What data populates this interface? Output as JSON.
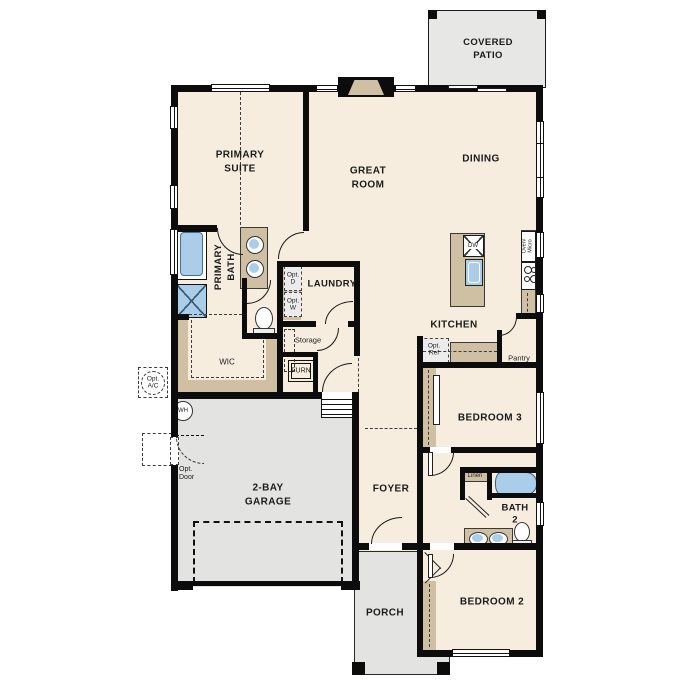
{
  "colors": {
    "wall": "#0c0c0c",
    "floor": "#f6edde",
    "concrete": "#e3e3e1",
    "patio": "#e7e7e5",
    "casework": "#cfc0a4",
    "fixture_blue": "#aacdea",
    "opt_fill": "#ececec"
  },
  "rooms": {
    "covered_patio": "COVERED\nPATIO",
    "primary_suite": "PRIMARY\nSUITE",
    "great_room": "GREAT\nROOM",
    "dining": "DINING",
    "kitchen": "KITCHEN",
    "laundry": "LAUNDRY",
    "primary_bath": "PRIMARY\nBATH",
    "wic": "WIC",
    "bedroom_3": "BEDROOM 3",
    "bath_2": "BATH\n2",
    "bedroom_2": "BEDROOM 2",
    "foyer": "FOYER",
    "garage": "2-BAY\nGARAGE",
    "porch": "PORCH",
    "storage": "Storage",
    "pantry": "Pantry",
    "linen": "Linen"
  },
  "fixtures": {
    "furnace": "FURN",
    "water_heater": "WH",
    "dishwasher": "DW",
    "oven_micro": "Oven/\nMicro",
    "opt_dryer": "Opt.\nD",
    "opt_washer": "Opt.\nW",
    "opt_refrigerator": "Opt.\nRef",
    "opt_ac": "Opt.\nA/C",
    "opt_door": "Opt.\nDoor"
  }
}
